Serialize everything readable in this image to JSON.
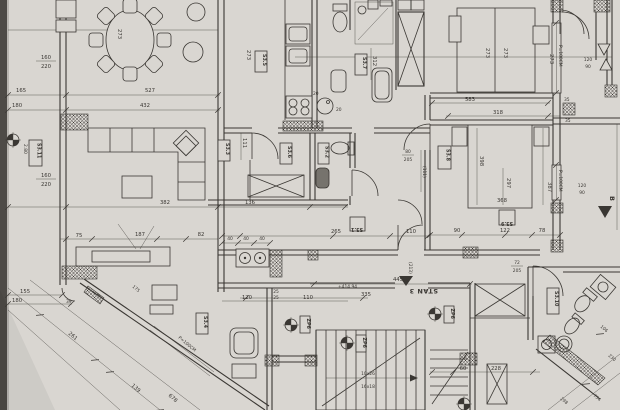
{
  "drawing": {
    "apartment_label": "STAN 3",
    "rooms": {
      "s31": "S3.1",
      "s32": "S3.2",
      "s33": "S3.3",
      "s34": "S3.4",
      "s35": "S3.5",
      "s36": "S3.6",
      "s37": "S3.7",
      "s38": "S3.8",
      "s39": "S3.9",
      "s310": "S3.10",
      "s311": "S3.11"
    },
    "markers": {
      "beam": "ZP6",
      "section": "B"
    },
    "notes": {
      "level": "+414.94",
      "window_sill": "P=100CM",
      "stairs_run": "10x26",
      "stairs_rise": "16x18",
      "height": "2.80"
    },
    "dims": {
      "d20": "20",
      "d25": "25",
      "d35": "35",
      "d39": "39",
      "d40": "40",
      "d60": "60",
      "d72": "72",
      "d75": "75",
      "d78": "78",
      "d80": "80",
      "d82": "82",
      "d90": "90",
      "d106": "106",
      "d110": "110",
      "d111": "111",
      "d111p": "(111)",
      "d120": "120",
      "d122": "122",
      "d136": "136",
      "d139": "139",
      "d155": "155",
      "d160": "160",
      "d165": "165",
      "d175": "175",
      "d180": "180",
      "d187": "187",
      "d205": "205",
      "d213": "(213)",
      "d220": "220",
      "d228": "228",
      "d230": "230",
      "d261": "261",
      "d265": "265",
      "d273": "273",
      "d297": "297",
      "d298": "298",
      "d312": "312",
      "d318": "318",
      "d335": "335",
      "d368": "368",
      "d382": "382",
      "d387": "387",
      "d398": "398",
      "d432": "432",
      "d445": "445",
      "d527": "527",
      "d583": "583",
      "d678": "678",
      "d754": "754"
    }
  },
  "colors": {
    "paper": "#d9d6d1",
    "ink": "#3a3733",
    "edge": "#4e4b47"
  }
}
